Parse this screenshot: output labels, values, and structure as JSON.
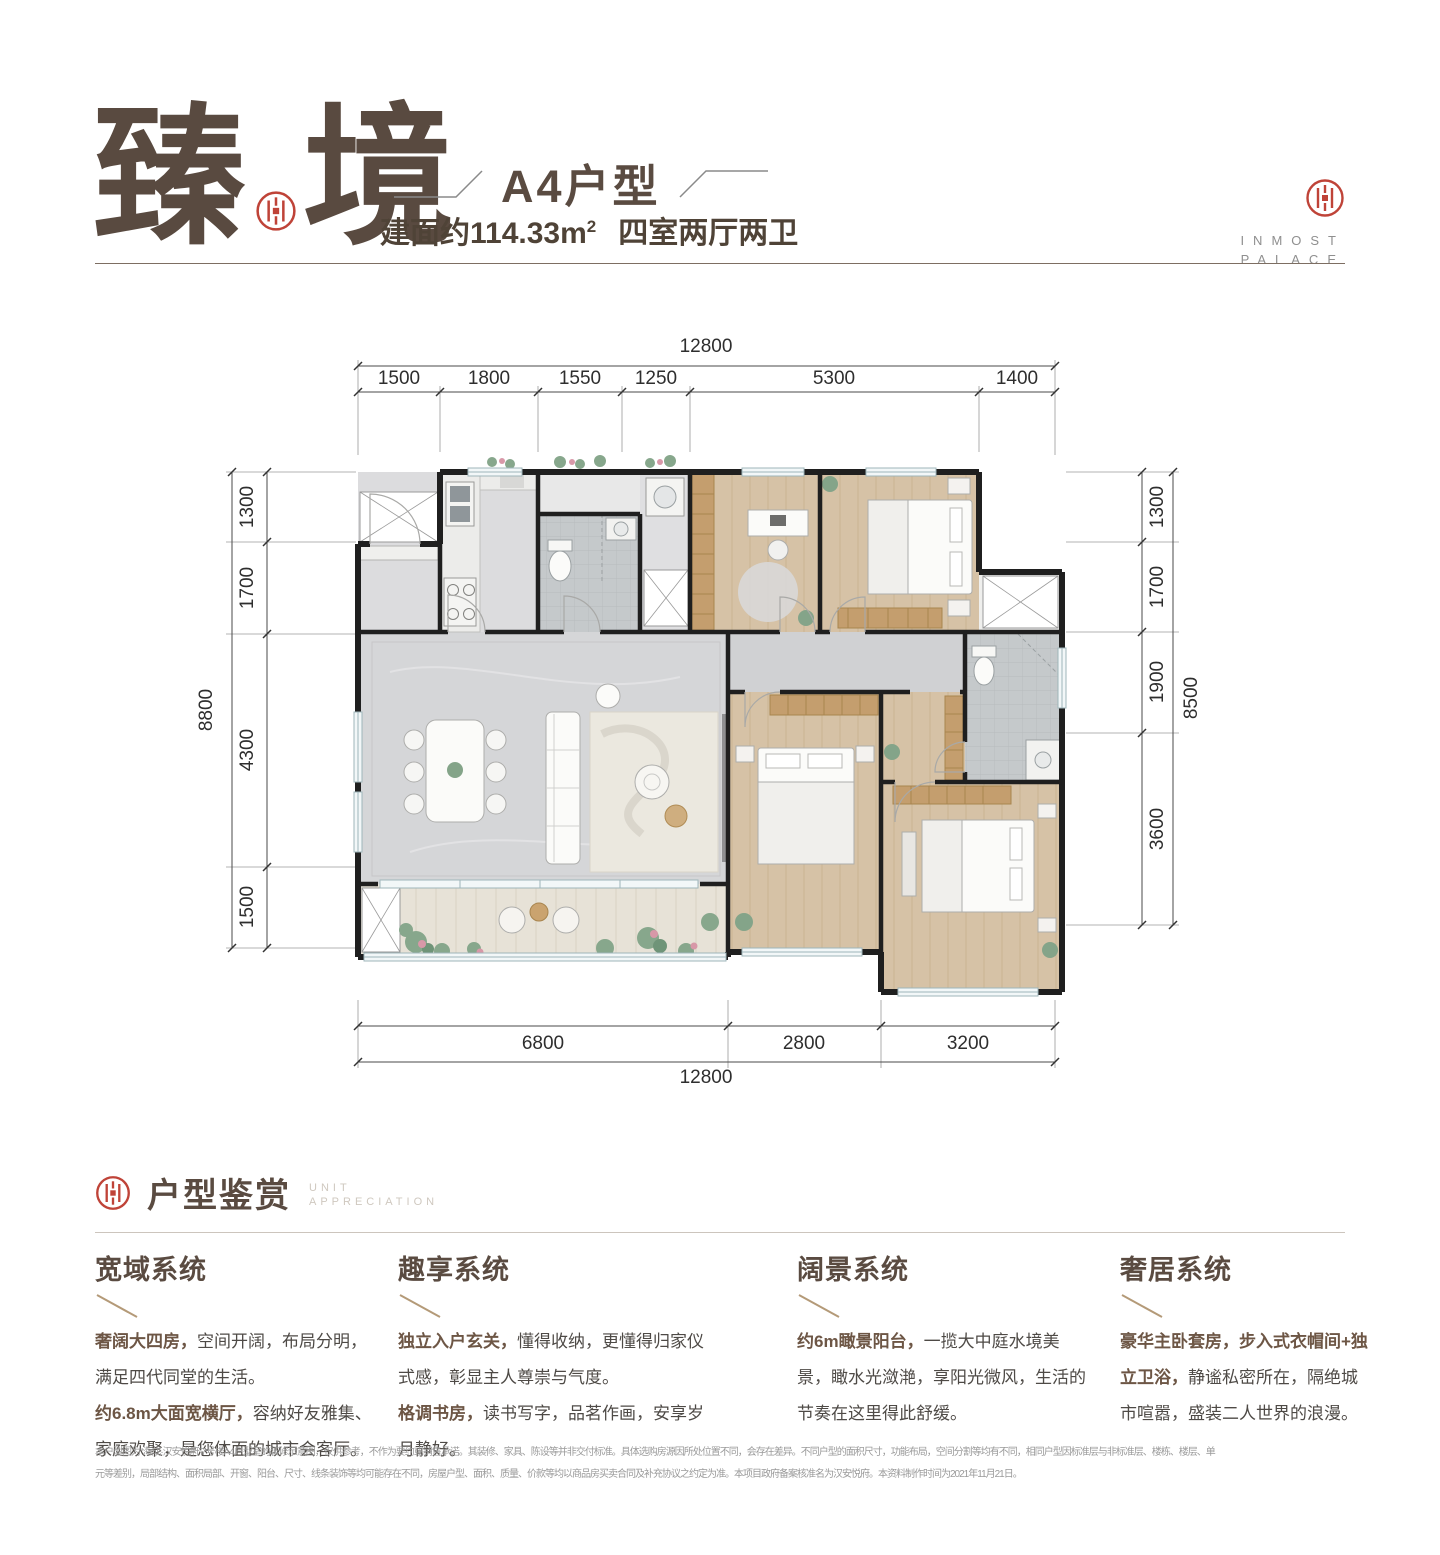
{
  "header": {
    "title_char1": "臻",
    "title_char2": "境",
    "unit_type": "A4户型",
    "area_main": "建面约114.33m",
    "area_sup": "2",
    "layout_desc": "四室两厅两卫",
    "brand_line1": "INMOST",
    "brand_line2": "PALACE"
  },
  "plan": {
    "dim_top": {
      "total": "12800",
      "segments": [
        "1500",
        "1800",
        "1550",
        "1250",
        "5300",
        "1400"
      ]
    },
    "dim_bottom": {
      "total": "12800",
      "segments": [
        "6800",
        "2800",
        "3200"
      ]
    },
    "dim_left": {
      "total": "8800",
      "segments": [
        "1300",
        "1700",
        "4300",
        "1500"
      ]
    },
    "dim_right": {
      "total": "8500",
      "segments": [
        "1300",
        "1700",
        "1900",
        "3600"
      ]
    }
  },
  "section": {
    "title": "户型鉴赏",
    "subtitle_line1": "UNIT",
    "subtitle_line2": "APPRECIATION",
    "columns": [
      {
        "heading": "宽域系统",
        "p1_bold": "奢阔大四房，",
        "p1_text": "空间开阔，布局分明，满足四代同堂的生活。",
        "p2_bold": "约6.8m大面宽横厅，",
        "p2_text": "容纳好友雅集、家庭欢聚，是您体面的城市会客厅。"
      },
      {
        "heading": "趣享系统",
        "p1_bold": "独立入户玄关，",
        "p1_text": "懂得收纳，更懂得归家仪式感，彰显主人尊崇与气度。",
        "p2_bold": "格调书房，",
        "p2_text": "读书写字，品茗作画，安享岁月静好。"
      },
      {
        "heading": "阔景系统",
        "p1_bold": "约6m瞰景阳台，",
        "p1_text": "一揽大中庭水境美景，瞰水光潋滟，享阳光微风，生活的节奏在这里得此舒缓。"
      },
      {
        "heading": "奢居系统",
        "p1_bold": "豪华主卧套房，步入式衣帽间+独立卫浴，",
        "p1_text": "静谧私密所在，隔绝城市喧嚣，盛装二人世界的浪漫。"
      }
    ]
  },
  "footer": {
    "line1": "本户型图为“海成·汉安悦府”7号楼A4户型室的装修示意图，仅供参考，不作为要约或销售承诺。其装修、家具、陈设等并非交付标准。具体选购房源因所处位置不同，会存在差异。不同户型的面积尺寸，功能布局，空间分割等均有不同，相同户型因标准层与非标准层、楼栋、楼层、单",
    "line2": "元等差别，局部结构、面积局部、开窗、阳台、尺寸、线条装饰等均可能存在不同，房屋户型、面积、质量、价款等均以商品房买卖合同及补充协议之约定为准。本项目政府备案核准名为汉安悦府。本资料制作时间为2021年11月21日。"
  },
  "colors": {
    "brand_red": "#bf4338",
    "title_brown": "#5a4b41",
    "accent_tan": "#b09877"
  }
}
